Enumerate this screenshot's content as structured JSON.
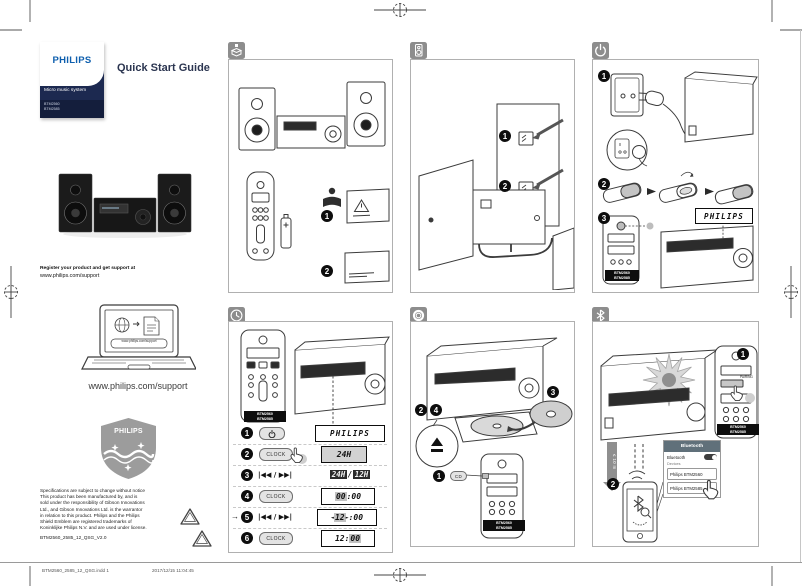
{
  "doc": {
    "brand": "PHILIPS",
    "title": "Quick Start Guide",
    "product_line": "Micro music system",
    "model_1": "BTM2560",
    "model_2": "BTM2585",
    "register_intro": "Register your product and get support at",
    "register_url": "www.philips.com/support",
    "laptop_screen_url": "www.philips.com/support",
    "support_url": "www.philips.com/support",
    "shield_brand": "PHILIPS",
    "legal": "Specifications are subject to change without notice\nThis product has been manufactured by, and is\nsold under the responsibility of Gibson Innovations\nLtd., and Gibson Innovations Ltd. is the warrantor\nin relation to this product. Philips and the Philips\nShield Emblem are registered trademarks of\nKoninklijke Philips N.V. and are used under license.",
    "doc_code": "BTM2560_2585_12_QSG_V2.0",
    "print_info": "BTM2560_2585_12_QSG.indd   1",
    "print_timestamp": "2017/12/15   11:04:45"
  },
  "colors": {
    "philips_blue": "#0e5fae",
    "navy_band": "#1c2950",
    "panel_icon_gray": "#8d8d8d",
    "lcd_highlight": "#c2c2c2"
  },
  "panels": {
    "remote_badge_line1": "BTM2560",
    "remote_badge_line2": "BTM2585",
    "unbox": {
      "step_1": "1",
      "step_2": "2"
    },
    "speakers": {
      "step_1": "1",
      "step_2": "2"
    },
    "power": {
      "step_1": "1",
      "step_2": "2",
      "step_3": "3",
      "display": "PHILIPS"
    },
    "clock": {
      "step_1": "1",
      "step_2": "2",
      "step_3": "3",
      "step_4": "4",
      "step_5": "5",
      "step_6": "6",
      "clock_button": "CLOCK",
      "skip_buttons": "|◀◀ / ▶▶|",
      "repeat_arrow": "→",
      "display_sep": ":",
      "display_1": "PHILIPS",
      "display_2": "24H",
      "display_3a": "24H",
      "display_3sep": "/",
      "display_3b": "12H",
      "display_4h": "00",
      "display_4m": "00",
      "display_5h": "12",
      "display_5m": "00",
      "display_5_left_arrow": "◄",
      "display_5_right_arrow": "►",
      "display_6h": "12",
      "display_6m": "00"
    },
    "cd": {
      "step_1": "1",
      "step_2": "2",
      "step_3": "3",
      "step_4": "4",
      "cd_button": "CD"
    },
    "bluetooth": {
      "step_1": "1",
      "step_2": "2",
      "pairing_button": "PAIRING",
      "distance": "≤ 10 m",
      "screen_title": "Bluetooth",
      "toggle_label": "Bluetooth",
      "devices_label": "Devices",
      "device_1": "Philips BTM2560",
      "device_2": "Philips BTM2585"
    }
  }
}
